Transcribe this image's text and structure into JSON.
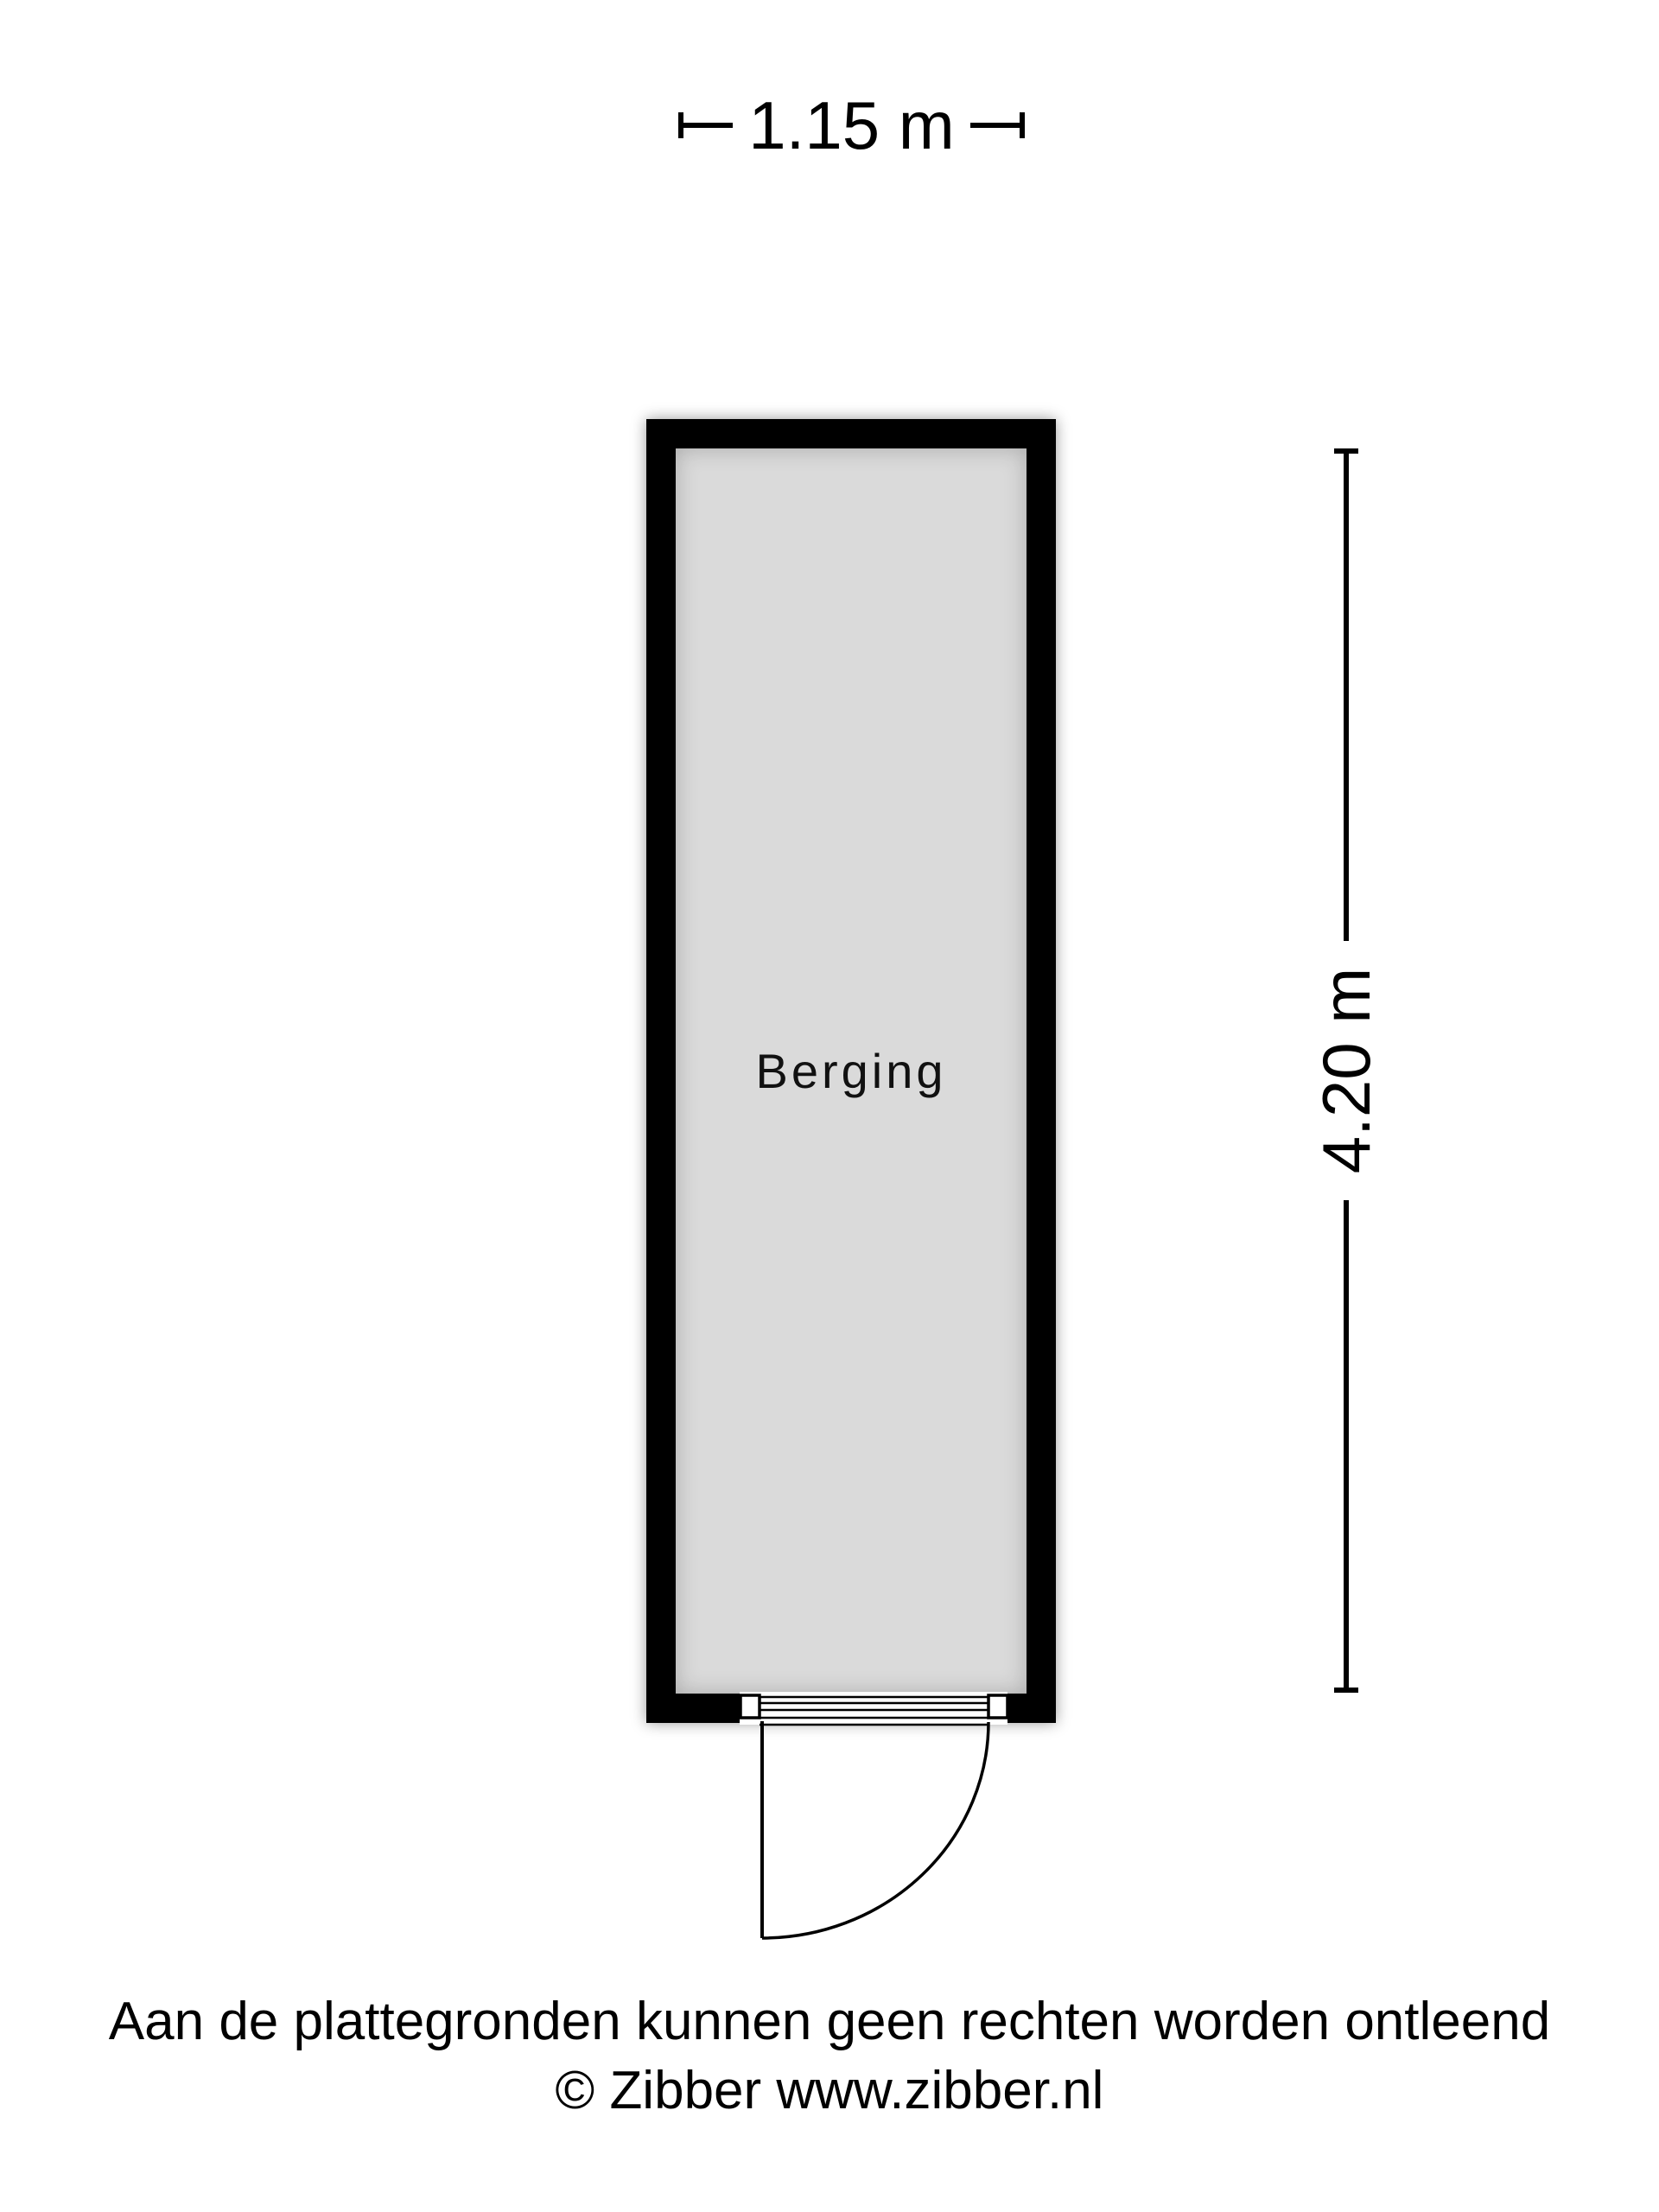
{
  "dimensions": {
    "width": {
      "label": "1.15 m"
    },
    "height": {
      "label": "4.20 m"
    }
  },
  "room": {
    "label": "Berging"
  },
  "footer": {
    "disclaimer": "Aan de plattegronden kunnen geen rechten worden ontleend",
    "copyright": "© Zibber www.zibber.nl"
  },
  "colors": {
    "wall": "#000000",
    "floor": "#dadada",
    "text": "#000000",
    "background": "#ffffff"
  }
}
